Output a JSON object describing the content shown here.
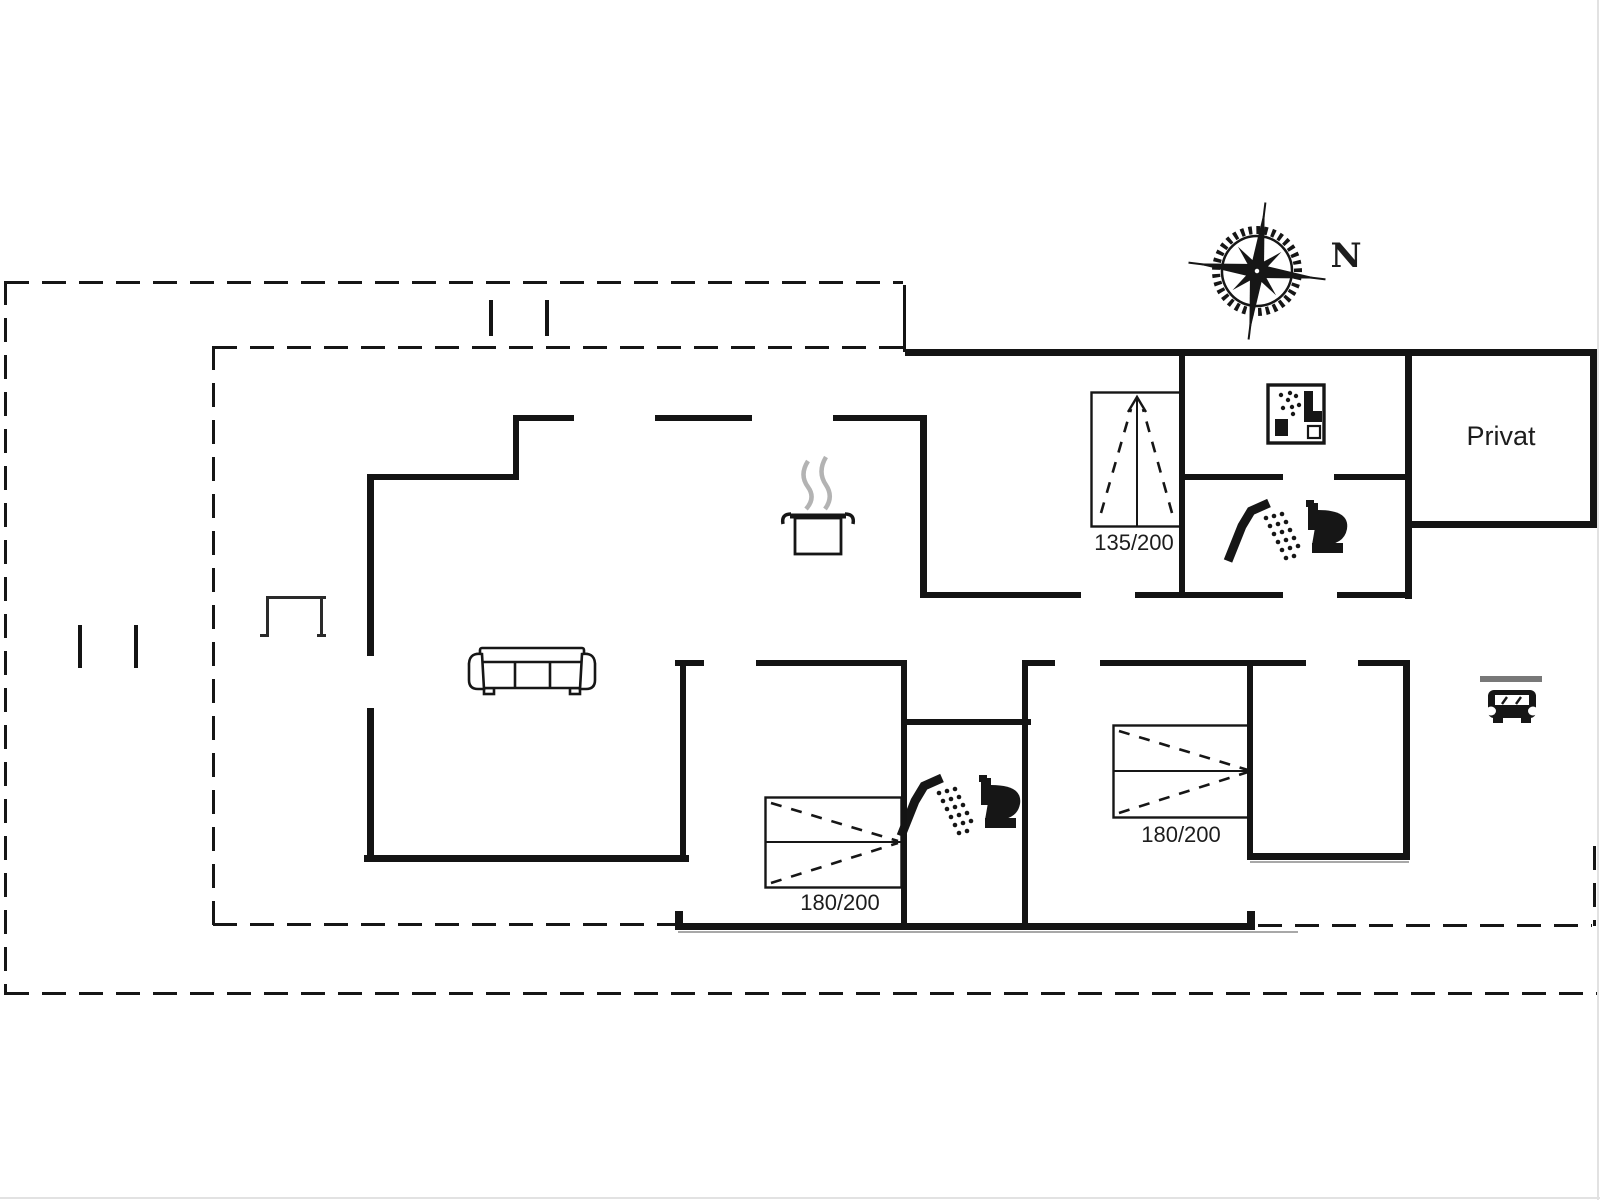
{
  "labels": {
    "privat": "Privat",
    "north": "N",
    "bed_top": "135/200",
    "bed_middle": "180/200",
    "bed_right": "180/200"
  },
  "icons": {
    "compass-rose": "compass rose pointing north",
    "pot-icon": "steaming cooking pot (kitchen)",
    "sofa-icon": "three-seat sofa (living room)",
    "washing-machine-icon": "washing machine",
    "shower-icon": "shower head with spray",
    "toilet-icon": "toilet",
    "car-icon": "car under carport",
    "garden-bench-icon": "small bench on terrace",
    "bed-symbol": "double bed with direction marks"
  },
  "colors": {
    "wall": "#141414",
    "line": "#161616",
    "steam": "#b3b3b3",
    "carport_bar": "#787878",
    "shadow": "#a8a8a8",
    "background": "#ffffff"
  },
  "floorplan": {
    "walls": [
      [
        905,
        349,
        692,
        7
      ],
      [
        1179,
        349,
        6,
        249
      ],
      [
        1405,
        349,
        7,
        250
      ],
      [
        1405,
        521,
        192,
        7
      ],
      [
        1590,
        349,
        7,
        179
      ],
      [
        1179,
        474,
        104,
        6
      ],
      [
        1334,
        474,
        77,
        6
      ],
      [
        920,
        592,
        161,
        6
      ],
      [
        1135,
        592,
        148,
        6
      ],
      [
        1337,
        592,
        74,
        6
      ],
      [
        920,
        415,
        7,
        183
      ],
      [
        516,
        415,
        58,
        6
      ],
      [
        655,
        415,
        97,
        6
      ],
      [
        833,
        415,
        92,
        6
      ],
      [
        513,
        415,
        6,
        65
      ],
      [
        367,
        474,
        152,
        6
      ],
      [
        367,
        474,
        7,
        182
      ],
      [
        367,
        708,
        7,
        153
      ],
      [
        364,
        855,
        325,
        7
      ],
      [
        680,
        660,
        6,
        200
      ],
      [
        675,
        923,
        580,
        7
      ],
      [
        675,
        911,
        8,
        14
      ],
      [
        1247,
        911,
        8,
        14
      ],
      [
        675,
        660,
        29,
        6
      ],
      [
        756,
        660,
        149,
        6
      ],
      [
        1022,
        660,
        33,
        6
      ],
      [
        1100,
        660,
        206,
        6
      ],
      [
        1358,
        660,
        50,
        6
      ],
      [
        901,
        660,
        6,
        266
      ],
      [
        901,
        719,
        130,
        6
      ],
      [
        1022,
        660,
        6,
        266
      ],
      [
        1247,
        660,
        6,
        199
      ],
      [
        1247,
        853,
        162,
        7
      ],
      [
        1403,
        660,
        7,
        200
      ],
      [
        903,
        285,
        3,
        67
      ]
    ],
    "ticks": [
      [
        489,
        300,
        4,
        36
      ],
      [
        545,
        300,
        4,
        36
      ],
      [
        78,
        625,
        4,
        43
      ],
      [
        134,
        625,
        4,
        43
      ]
    ],
    "dashed": [
      [
        5,
        281,
        898,
        "h"
      ],
      [
        4,
        281,
        714,
        "v"
      ],
      [
        5,
        992,
        1592,
        "h"
      ],
      [
        213,
        346,
        692,
        "h"
      ],
      [
        212,
        346,
        582,
        "v"
      ],
      [
        213,
        923,
        462,
        "h"
      ],
      [
        1258,
        924,
        334,
        "h"
      ],
      [
        1593,
        846,
        80,
        "v"
      ]
    ],
    "thin": [
      [
        266,
        596,
        60,
        3
      ],
      [
        266,
        596,
        3,
        41
      ],
      [
        320,
        596,
        3,
        41
      ],
      [
        260,
        634,
        9,
        3
      ],
      [
        317,
        634,
        9,
        3
      ]
    ],
    "shadows": [
      [
        678,
        931,
        620,
        2
      ],
      [
        1250,
        861,
        159,
        2
      ]
    ]
  }
}
